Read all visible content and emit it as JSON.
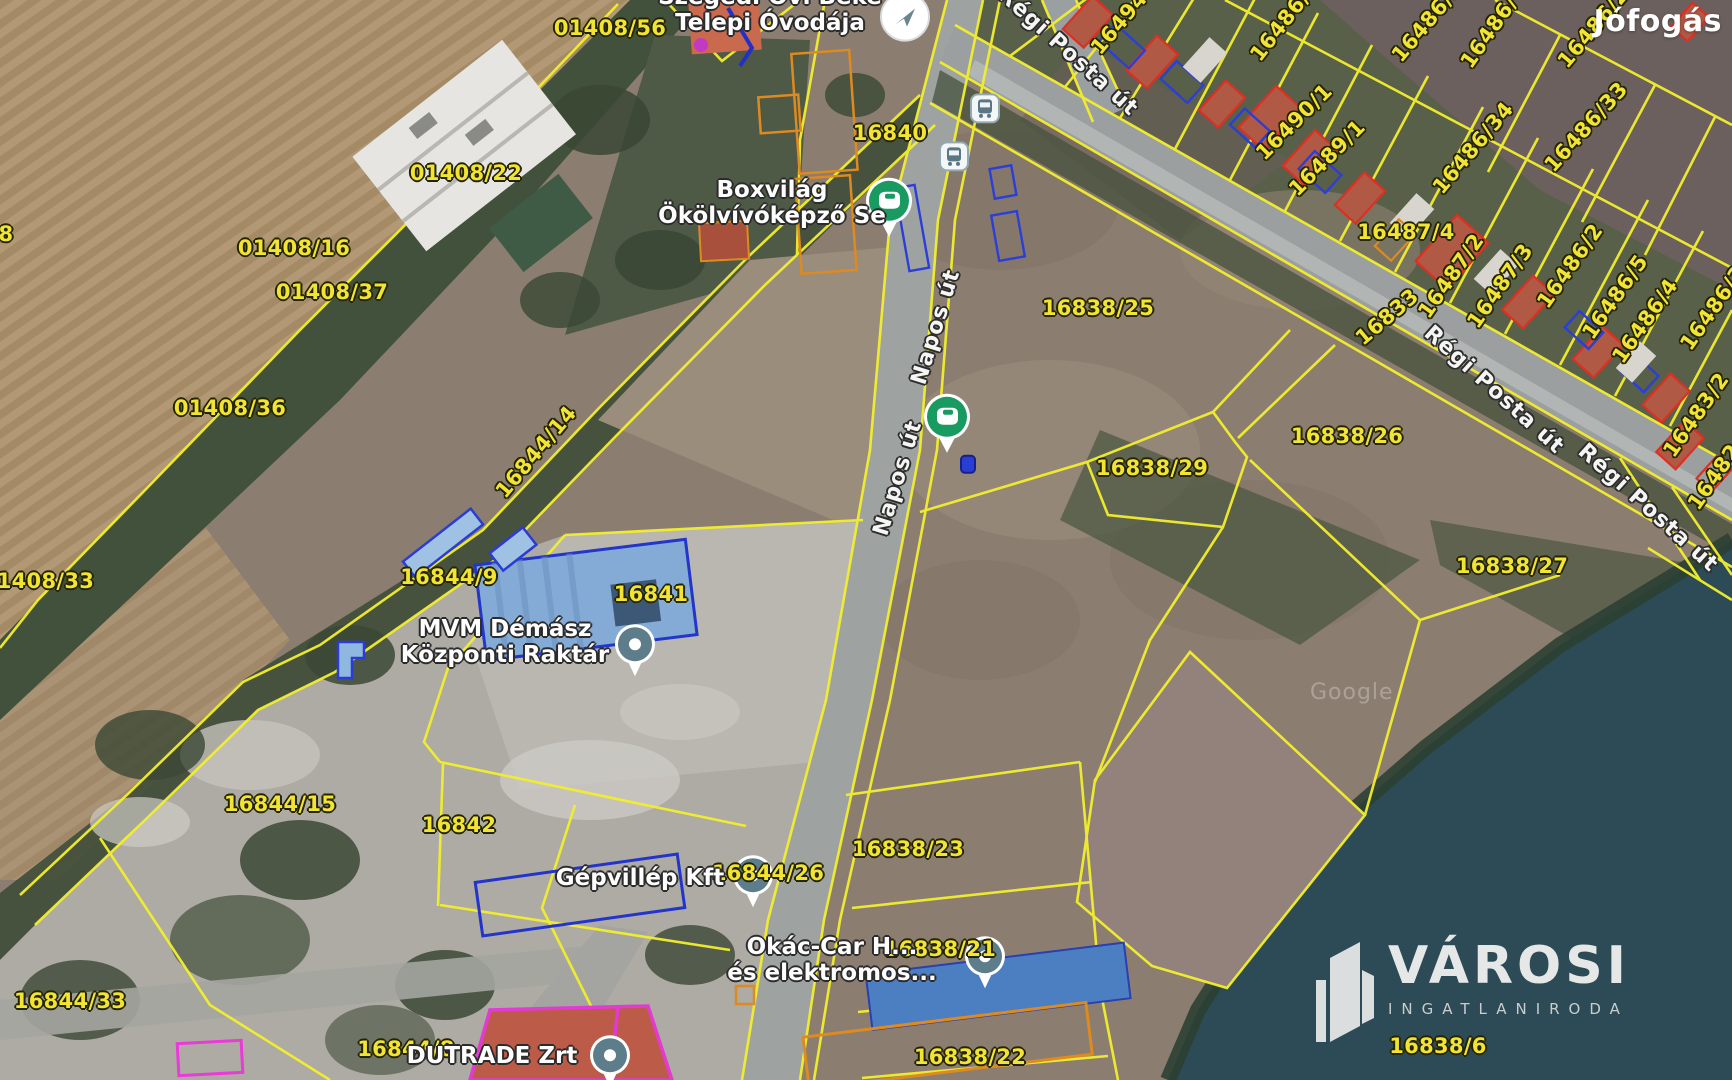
{
  "watermarks": {
    "listing_logo": "Jófogás",
    "agency_name": "VÁROSI",
    "agency_subtitle": "INGATLANIRODA",
    "imagery_attribution": "Google"
  },
  "colors": {
    "parcel_label": "#f2e435",
    "parcel_line": "#f3ef2d",
    "street_label": "#f5f5f3",
    "building_outline_red": "#dd2f22",
    "building_outline_blue": "#2c3ed8",
    "building_outline_orange": "#dd8a21",
    "building_outline_magenta": "#e23ad2",
    "marker_green": "#189a60",
    "marker_gray": "#5d7d8b",
    "water": "#2d4b56"
  },
  "parcel_labels": [
    {
      "t": "01408/56",
      "x": 610,
      "y": 28,
      "r": 0
    },
    {
      "t": "01408/22",
      "x": 466,
      "y": 173,
      "r": 0
    },
    {
      "t": "01408/16",
      "x": 294,
      "y": 248,
      "r": 0
    },
    {
      "t": "01408/37",
      "x": 332,
      "y": 292,
      "r": 0
    },
    {
      "t": "01408/36",
      "x": 230,
      "y": 408,
      "r": 0
    },
    {
      "t": "01408/33",
      "x": 38,
      "y": 581,
      "r": 0
    },
    {
      "t": "8",
      "x": 6,
      "y": 234,
      "r": 0
    },
    {
      "t": "16844/14",
      "x": 536,
      "y": 452,
      "r": -50
    },
    {
      "t": "16844/9",
      "x": 449,
      "y": 577,
      "r": 0
    },
    {
      "t": "16841",
      "x": 651,
      "y": 594,
      "r": 0
    },
    {
      "t": "16844/15",
      "x": 280,
      "y": 804,
      "r": 0
    },
    {
      "t": "16842",
      "x": 459,
      "y": 825,
      "r": 0
    },
    {
      "t": "16844/33",
      "x": 70,
      "y": 1001,
      "r": 0
    },
    {
      "t": "16844/8",
      "x": 406,
      "y": 1049,
      "r": 0
    },
    {
      "t": "16844/26",
      "x": 768,
      "y": 873,
      "r": 0
    },
    {
      "t": "16840",
      "x": 890,
      "y": 133,
      "r": 0
    },
    {
      "t": "16838/25",
      "x": 1098,
      "y": 308,
      "r": 0
    },
    {
      "t": "16838/29",
      "x": 1152,
      "y": 468,
      "r": 0
    },
    {
      "t": "16838/26",
      "x": 1347,
      "y": 436,
      "r": 0
    },
    {
      "t": "16838/27",
      "x": 1512,
      "y": 566,
      "r": 0
    },
    {
      "t": "16838/23",
      "x": 908,
      "y": 849,
      "r": 0
    },
    {
      "t": "16838/21",
      "x": 940,
      "y": 949,
      "r": 0
    },
    {
      "t": "16838/22",
      "x": 970,
      "y": 1057,
      "r": 0
    },
    {
      "t": "16838/6",
      "x": 1438,
      "y": 1046,
      "r": 0
    },
    {
      "t": "16494",
      "x": 1119,
      "y": 23,
      "r": -50
    },
    {
      "t": "16486/",
      "x": 1280,
      "y": 26,
      "r": -52
    },
    {
      "t": "16490/1",
      "x": 1294,
      "y": 122,
      "r": -45
    },
    {
      "t": "16489/1",
      "x": 1327,
      "y": 158,
      "r": -45
    },
    {
      "t": "16486/32",
      "x": 1432,
      "y": 16,
      "r": -50
    },
    {
      "t": "16486/",
      "x": 1489,
      "y": 32,
      "r": -55
    },
    {
      "t": "16486/23",
      "x": 1598,
      "y": 22,
      "r": -50
    },
    {
      "t": "16486/34",
      "x": 1473,
      "y": 148,
      "r": -50
    },
    {
      "t": "16486/33",
      "x": 1586,
      "y": 127,
      "r": -48
    },
    {
      "t": "16487/4",
      "x": 1406,
      "y": 232,
      "r": 0
    },
    {
      "t": "16487/2",
      "x": 1451,
      "y": 276,
      "r": -55
    },
    {
      "t": "16487/3",
      "x": 1500,
      "y": 286,
      "r": -55
    },
    {
      "t": "16486/2",
      "x": 1570,
      "y": 266,
      "r": -55
    },
    {
      "t": "16486/5",
      "x": 1615,
      "y": 297,
      "r": -55
    },
    {
      "t": "16486/4",
      "x": 1645,
      "y": 321,
      "r": -55
    },
    {
      "t": "16486/3",
      "x": 1713,
      "y": 308,
      "r": -55
    },
    {
      "t": "16833",
      "x": 1387,
      "y": 317,
      "r": -40
    },
    {
      "t": "16483/2",
      "x": 1696,
      "y": 415,
      "r": -55
    },
    {
      "t": "16482",
      "x": 1714,
      "y": 477,
      "r": -55
    }
  ],
  "street_labels": [
    {
      "t": "Régi Posta út",
      "x": 1068,
      "y": 52,
      "r": 42
    },
    {
      "t": "Régi Posta út",
      "x": 1494,
      "y": 390,
      "r": 42
    },
    {
      "t": "Régi Posta út",
      "x": 1648,
      "y": 508,
      "r": 42
    },
    {
      "t": "Napos út",
      "x": 936,
      "y": 327,
      "r": -73
    },
    {
      "t": "Napos út",
      "x": 898,
      "y": 478,
      "r": -73
    }
  ],
  "poi_labels": [
    {
      "lines": [
        "Szegedi Óvi Béke",
        "Telepi Óvodája"
      ],
      "x": 770,
      "y": 10
    },
    {
      "lines": [
        "Boxvilág",
        "Ökölvívóképző Se"
      ],
      "x": 772,
      "y": 203
    },
    {
      "lines": [
        "MVM Démász",
        "Központi Raktár"
      ],
      "x": 505,
      "y": 642
    },
    {
      "lines": [
        "Gépvillép Kft"
      ],
      "x": 640,
      "y": 878
    },
    {
      "lines": [
        "Okác-Car H...",
        "és elektromos..."
      ],
      "x": 832,
      "y": 960
    },
    {
      "lines": [
        "DUTRADE Zrt"
      ],
      "x": 492,
      "y": 1056
    }
  ],
  "markers": [
    {
      "kind": "transit-circle",
      "x": 905,
      "y": 13
    },
    {
      "kind": "bus-stop",
      "x": 985,
      "y": 107
    },
    {
      "kind": "bus-stop",
      "x": 954,
      "y": 155
    },
    {
      "kind": "green-club",
      "x": 889,
      "y": 203
    },
    {
      "kind": "green-club",
      "x": 947,
      "y": 419
    },
    {
      "kind": "blue-dot",
      "x": 968,
      "y": 465
    },
    {
      "kind": "gray-pin",
      "x": 635,
      "y": 646
    },
    {
      "kind": "gray-pin",
      "x": 753,
      "y": 877
    },
    {
      "kind": "gray-pin",
      "x": 985,
      "y": 958
    },
    {
      "kind": "gray-pin",
      "x": 610,
      "y": 1057
    }
  ]
}
